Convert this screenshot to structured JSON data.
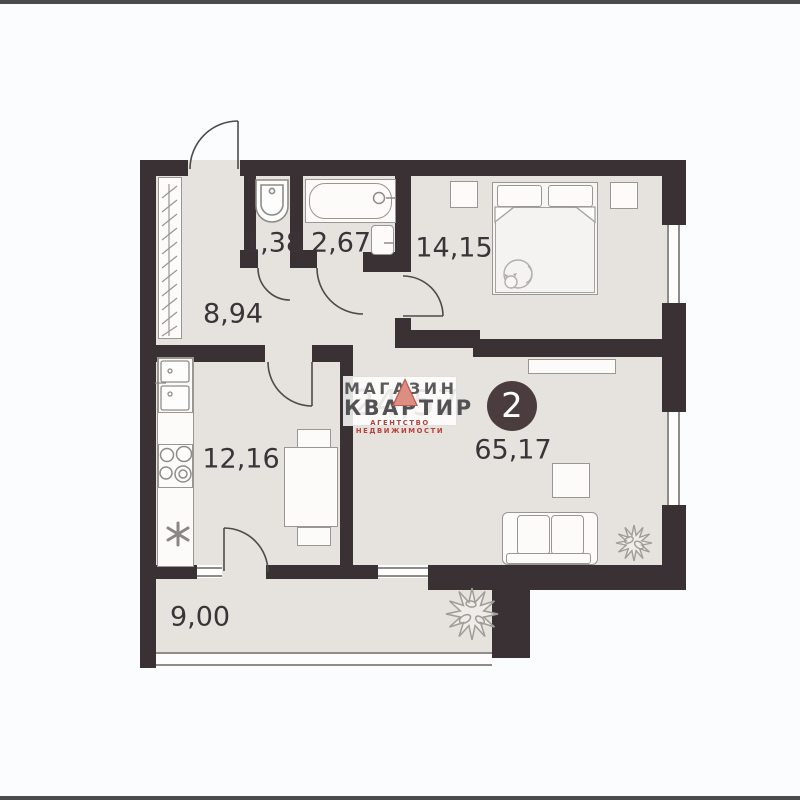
{
  "window": {
    "background": "#fbfcfe",
    "top_bar_color": "#4a4a4a",
    "bottom_bar_color": "#4a4a4a"
  },
  "plan": {
    "wall_color": "#3a3134",
    "floor_color": "#e6e3df",
    "badge_rooms": "2",
    "labels": {
      "wc": "1,38",
      "bathroom": "2,67",
      "bedroom": "14,15",
      "hallway": "8,94",
      "kitchen": "12,16",
      "living": "65,17",
      "balcony": "9,00"
    },
    "underlay_area": "24,57",
    "icons": [
      "entrance-door-arc",
      "wc-door-arc",
      "bath-door-arc",
      "bedroom-door-arc",
      "kitchen-door-arc",
      "balcony-door-arc",
      "toilet-icon",
      "bathtub-icon",
      "washbasin-icon",
      "closet-hatch-icon",
      "fridge-icon",
      "stove-icon",
      "sink-asterisk-icon",
      "bed-icon",
      "cat-icon",
      "sofa-icon",
      "tv-shelf-icon",
      "plant-icon-small",
      "plant-icon-large"
    ]
  },
  "watermark": {
    "line1": "МАГАЗИН",
    "line2": "КВАРТИР",
    "tagline": "АГЕНТСТВО НЕДВИЖИМОСТИ",
    "triangle_color": "#dd8e84",
    "text_color": "#5a5a5c",
    "tagline_color": "#b5403c"
  }
}
